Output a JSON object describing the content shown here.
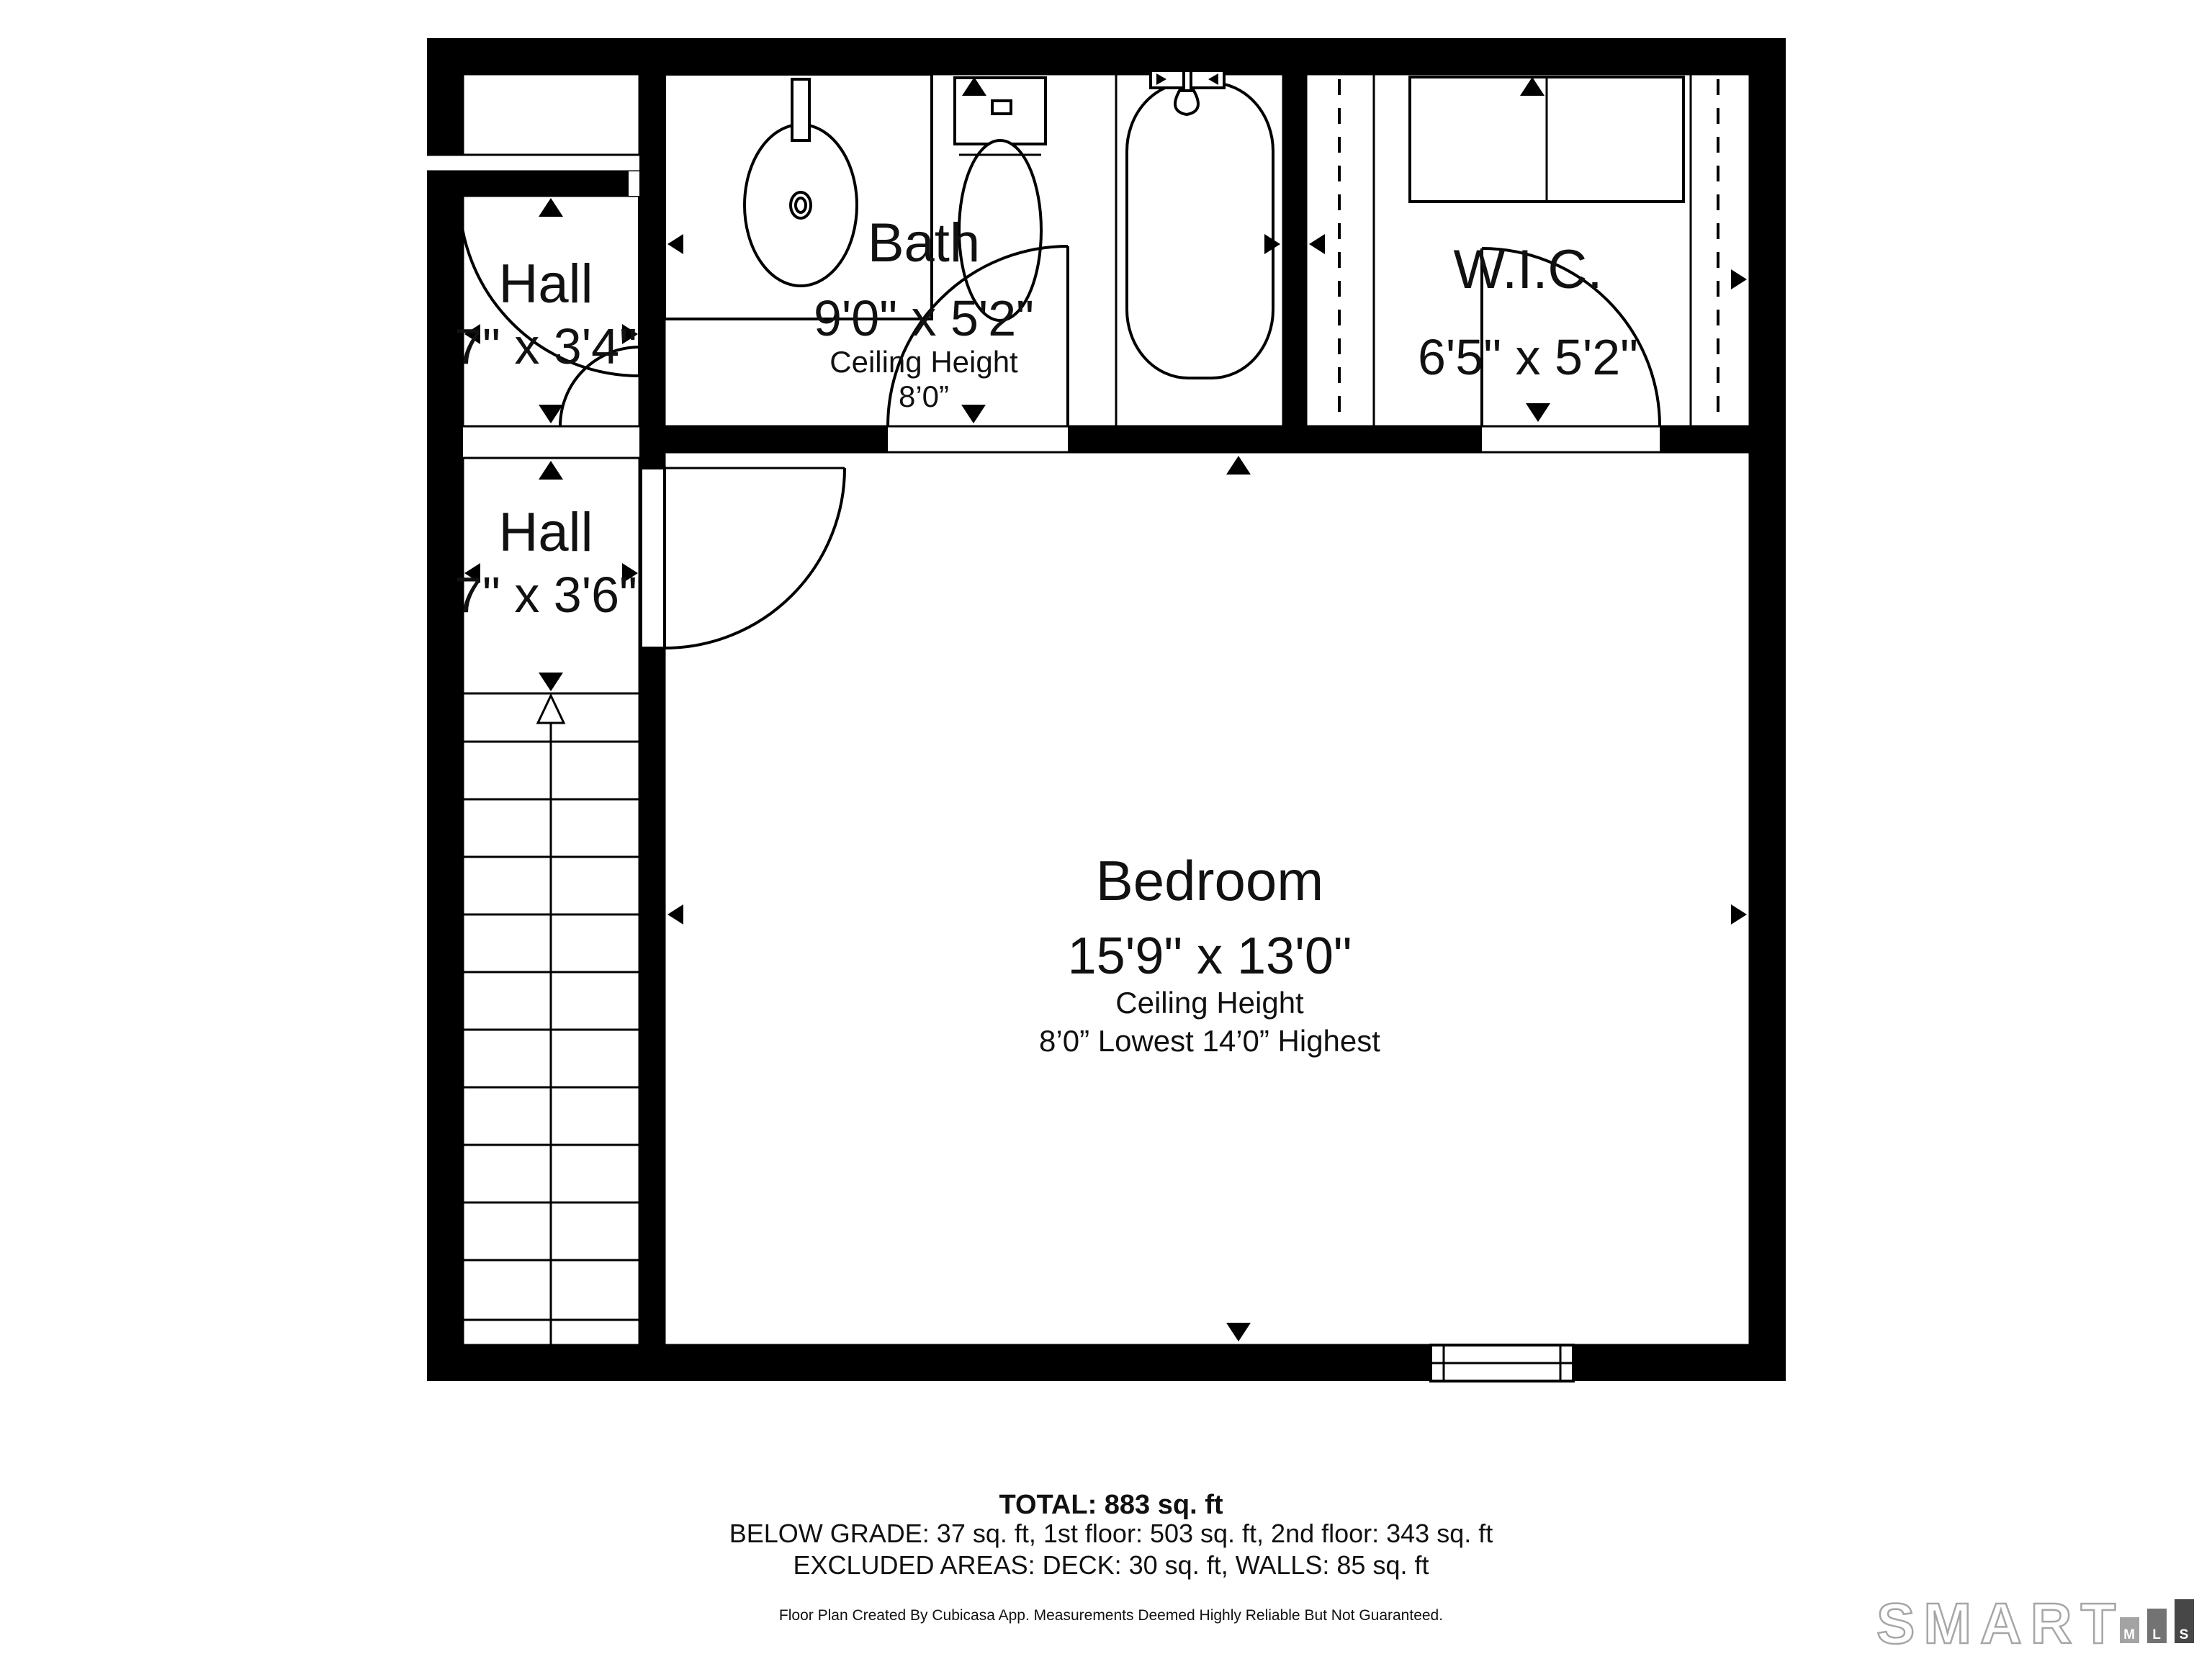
{
  "rooms": {
    "hall1": {
      "name": "Hall",
      "dims": "7\" x 3'4\""
    },
    "hall2": {
      "name": "Hall",
      "dims": "7\" x 3'6\""
    },
    "bath": {
      "name": "Bath",
      "dims": "9'0\" x 5'2\"",
      "ceiling_label": "Ceiling Height",
      "ceiling_value": "8’0”"
    },
    "wic": {
      "name": "W.I.C.",
      "dims": "6'5\" x 5'2\""
    },
    "bedroom": {
      "name": "Bedroom",
      "dims": "15'9\" x 13'0\"",
      "ceiling_label": "Ceiling Height",
      "ceiling_value": "8’0” Lowest 14’0” Highest"
    }
  },
  "summary": {
    "total": "TOTAL: 883 sq. ft",
    "breakdown": "BELOW GRADE: 37 sq. ft, 1st floor: 503 sq. ft, 2nd floor: 343 sq. ft",
    "excluded": "EXCLUDED AREAS: DECK: 30 sq. ft, WALLS: 85 sq. ft",
    "disclaimer": "Floor Plan Created By Cubicasa App. Measurements Deemed Highly Reliable But Not Guaranteed."
  },
  "branding": {
    "logo_text": "SMART",
    "bars": {
      "m": "M",
      "l": "L",
      "s": "S"
    },
    "colors": {
      "outline": "#a6a6a6",
      "bar_m": "#a3a3a3",
      "bar_l": "#737373",
      "bar_s": "#474747"
    }
  }
}
